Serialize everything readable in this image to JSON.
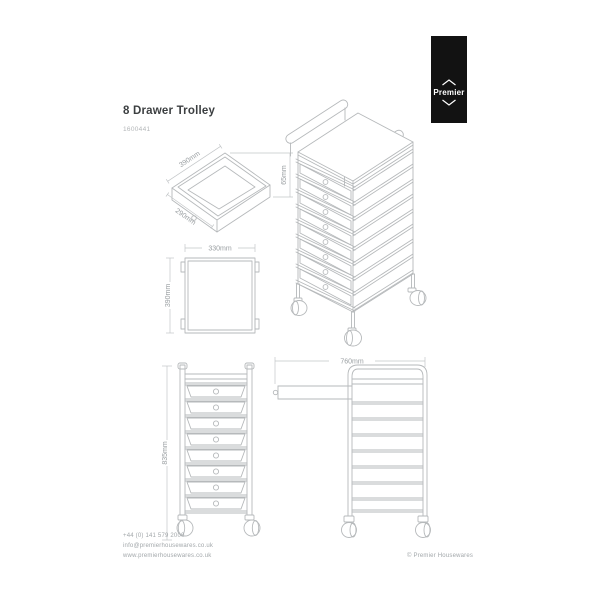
{
  "header": {
    "title": "8 Drawer Trolley",
    "product_code": "1600441"
  },
  "logo": {
    "brand": "Premier"
  },
  "dimensions": {
    "tray_width": "390mm",
    "tray_depth": "290mm",
    "tray_height": "65mm",
    "top_width": "330mm",
    "top_depth": "390mm",
    "front_height": "835mm",
    "side_extended": "760mm"
  },
  "footer": {
    "phone": "+44 (0) 141 579 2000",
    "email": "info@premierhousewares.co.uk",
    "website": "www.premierhousewares.co.uk",
    "copyright": "© Premier Housewares"
  },
  "colors": {
    "line": "#b6b9bb",
    "dim_text": "#999ea1",
    "title_text": "#3c3f41",
    "muted_text": "#a2a7aa",
    "logo_bg": "#121212",
    "logo_text": "#ffffff"
  }
}
